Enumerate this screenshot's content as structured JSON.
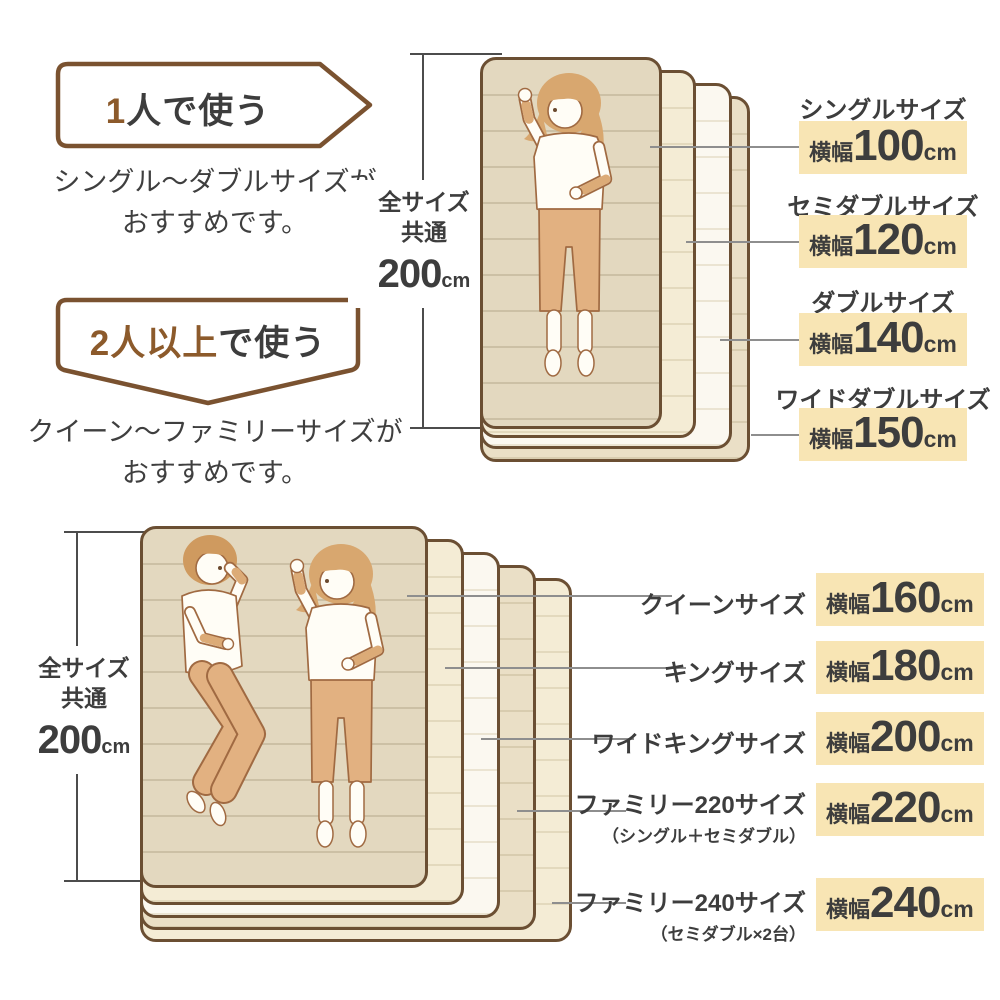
{
  "colors": {
    "accent_brown": "#8c5a2b",
    "badge_border": "#7a5230",
    "text_dark": "#3d3d3d",
    "highlight_yellow": "#f8e5b4",
    "mattress_border": "#6b4f33",
    "mattress_tan": "#e3d8bf",
    "mattress_cream": "#f4ecd5",
    "mattress_white": "#fbf8f0",
    "leader_gray": "#8e8e8e"
  },
  "intro_single": {
    "badge_accent": "1",
    "badge_rest": "人で使う",
    "desc_line1": "シングル〜ダブルサイズが",
    "desc_line2": "おすすめです。"
  },
  "intro_multi": {
    "badge_accent": "2人以上",
    "badge_rest": "で使う",
    "desc_line1": "クイーン〜ファミリーサイズが",
    "desc_line2": "おすすめです。"
  },
  "measure": {
    "line1": "全サイズ",
    "line2": "共通",
    "value": "200",
    "unit": "cm"
  },
  "single_group": {
    "sizes": [
      {
        "name": "シングルサイズ",
        "width_prefix": "横幅",
        "value": "100",
        "unit": "cm"
      },
      {
        "name": "セミダブルサイズ",
        "width_prefix": "横幅",
        "value": "120",
        "unit": "cm"
      },
      {
        "name": "ダブルサイズ",
        "width_prefix": "横幅",
        "value": "140",
        "unit": "cm"
      },
      {
        "name": "ワイドダブルサイズ",
        "width_prefix": "横幅",
        "value": "150",
        "unit": "cm"
      }
    ]
  },
  "multi_group": {
    "sizes": [
      {
        "name": "クイーンサイズ",
        "note": "",
        "width_prefix": "横幅",
        "value": "160",
        "unit": "cm"
      },
      {
        "name": "キングサイズ",
        "note": "",
        "width_prefix": "横幅",
        "value": "180",
        "unit": "cm"
      },
      {
        "name": "ワイドキングサイズ",
        "note": "",
        "width_prefix": "横幅",
        "value": "200",
        "unit": "cm"
      },
      {
        "name": "ファミリー220サイズ",
        "note": "（シングル＋セミダブル）",
        "width_prefix": "横幅",
        "value": "220",
        "unit": "cm"
      },
      {
        "name": "ファミリー240サイズ",
        "note": "（セミダブル×2台）",
        "width_prefix": "横幅",
        "value": "240",
        "unit": "cm"
      }
    ]
  }
}
